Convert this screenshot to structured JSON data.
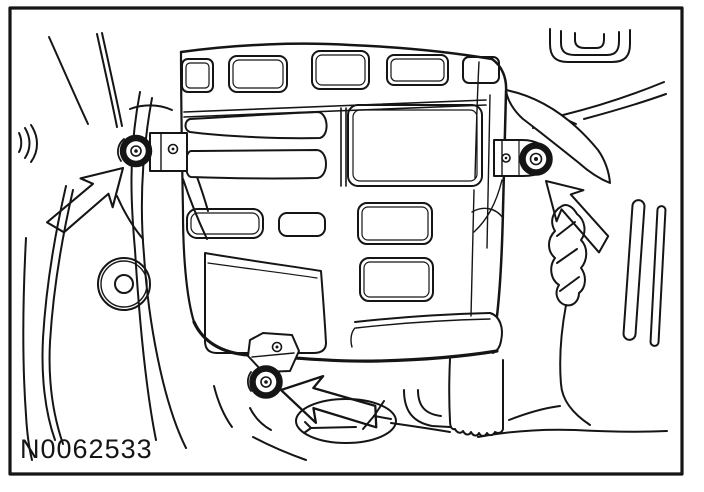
{
  "figure": {
    "label": "N0062533",
    "fastener_count": 3,
    "callouts": [
      {
        "name": "left-bolt-callout-arrow",
        "points": "up-right"
      },
      {
        "name": "right-bolt-callout-arrow",
        "points": "up-left"
      },
      {
        "name": "bottom-bolt-callout-arrow",
        "points": "left"
      }
    ],
    "colors": {
      "ink": "#151515",
      "background": "#ffffff"
    }
  }
}
